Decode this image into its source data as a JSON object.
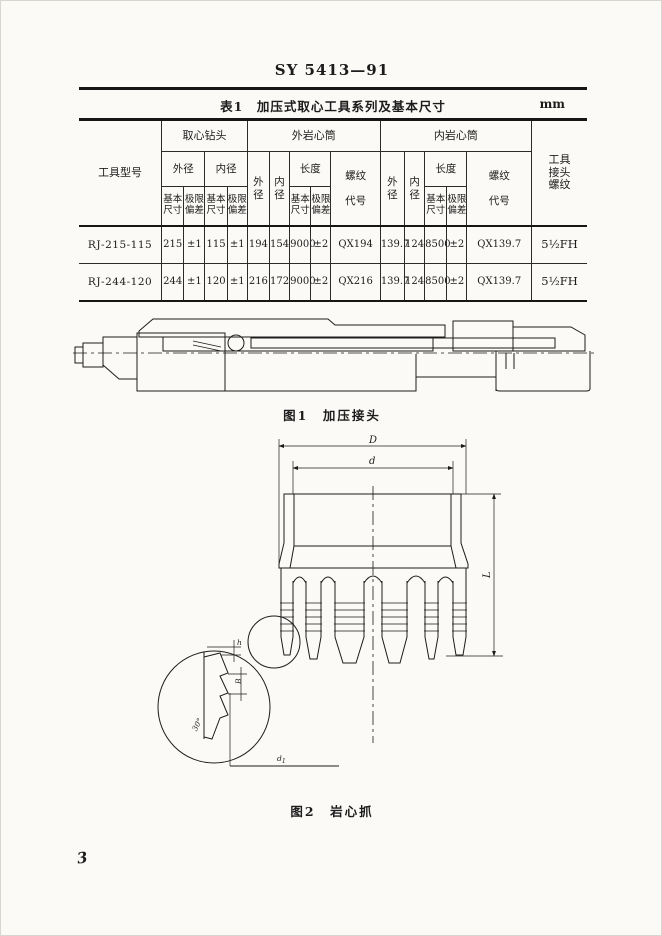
{
  "page": {
    "doc_number": "SY 5413—91",
    "page_number": "3"
  },
  "colors": {
    "ink": "#1c1c1c",
    "paper": "#fbfaf7"
  },
  "table1": {
    "caption": "表1　加压式取心工具系列及基本尺寸",
    "unit": "mm",
    "headers": {
      "tool_model": "工具型号",
      "coring_bit": "取心钻头",
      "outer_core_barrel": "外岩心筒",
      "inner_core_barrel": "内岩心筒",
      "tool_joint_thread": "工具\n接头\n螺纹",
      "outer_dia": "外径",
      "inner_dia": "内径",
      "outer_dia_stacked": "外\n径",
      "inner_dia_stacked": "内\n径",
      "length": "长度",
      "thread_code": "螺纹\n\n代号",
      "basic_size": "基本\n尺寸",
      "limit_dev": "极限\n偏差"
    },
    "rows": [
      {
        "model": "RJ-215-115",
        "bit_od": "215",
        "bit_od_dev": "±1",
        "bit_id": "115",
        "bit_id_dev": "±1",
        "ob_od": "194",
        "ob_id": "154",
        "ob_len": "9000",
        "ob_len_dev": "±2",
        "ob_thread": "QX194",
        "ib_od": "139.7",
        "ib_id": "124",
        "ib_len": "8500",
        "ib_len_dev": "±2",
        "ib_thread": "QX139.7",
        "joint_thread": "5½FH"
      },
      {
        "model": "RJ-244-120",
        "bit_od": "244",
        "bit_od_dev": "±1",
        "bit_id": "120",
        "bit_id_dev": "±1",
        "ob_od": "216",
        "ob_id": "172",
        "ob_len": "9000",
        "ob_len_dev": "±2",
        "ob_thread": "QX216",
        "ib_od": "139.7",
        "ib_id": "124",
        "ib_len": "8500",
        "ib_len_dev": "±2",
        "ib_thread": "QX139.7",
        "joint_thread": "5½FH"
      }
    ]
  },
  "figure1": {
    "caption": "图1　加压接头"
  },
  "figure2": {
    "caption": "图2　岩心抓",
    "labels": {
      "D": "D",
      "d": "d",
      "L": "L",
      "h": "h",
      "pitch": "B",
      "angle": "30°",
      "d1_base": "d",
      "d1_sub": "1"
    }
  }
}
